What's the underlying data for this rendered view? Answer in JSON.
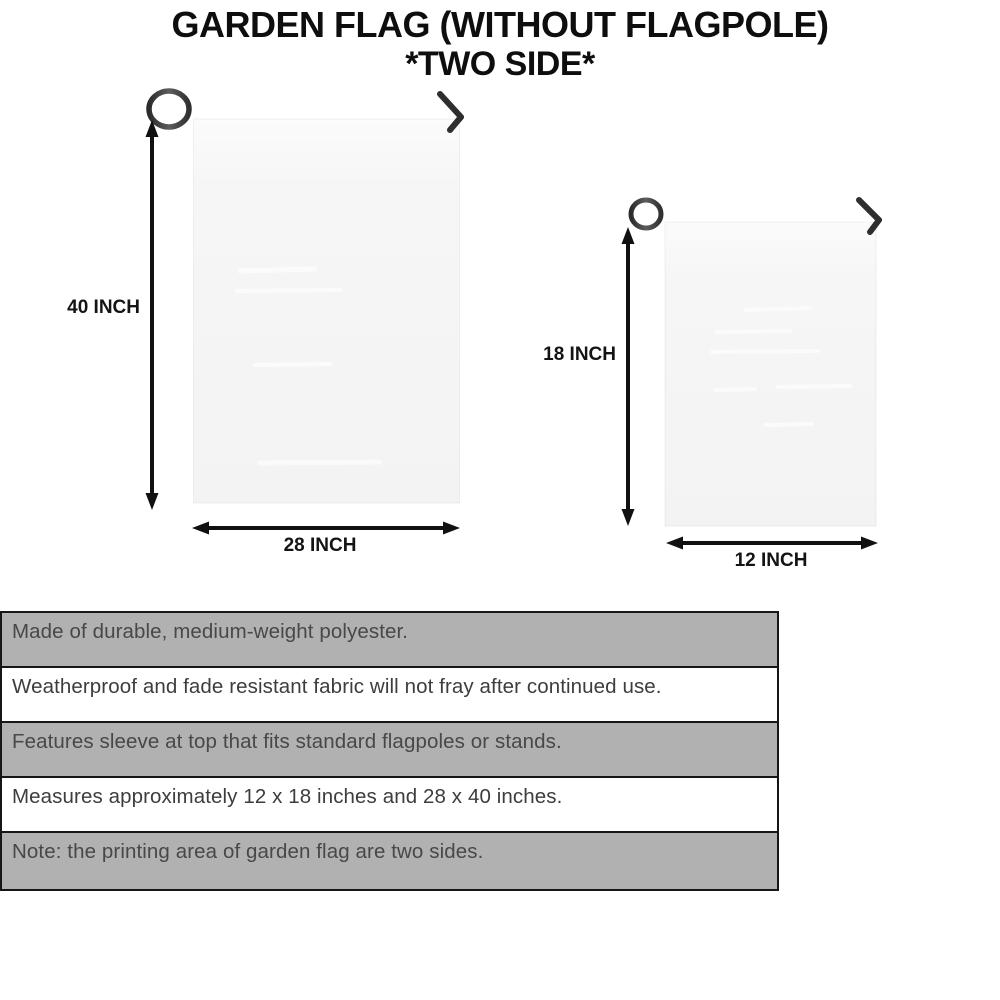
{
  "title": {
    "line1": "GARDEN FLAG (WITHOUT FLAGPOLE)",
    "line2": "*TWO SIDE*"
  },
  "large_flag": {
    "name": "28 x 40 inch garden flag",
    "height_label": "40 INCH",
    "width_label": "28 INCH"
  },
  "small_flag": {
    "name": "12 x 18 inch garden flag",
    "height_label": "18 INCH",
    "width_label": "12 INCH"
  },
  "features": {
    "rows": [
      {
        "text": "Made of durable, medium-weight polyester."
      },
      {
        "text": "Weatherproof and fade resistant fabric will not fray after continued use."
      },
      {
        "text": "Features sleeve at top that fits standard flagpoles or stands."
      },
      {
        "text": "Measures approximately 12 x 18 inches and 28 x 40 inches."
      },
      {
        "text": "Note: the printing area of garden flag are two sides."
      }
    ]
  },
  "colors": {
    "title_text": "#0e0e0e",
    "arrow": "#111111",
    "pole": "#454545",
    "hook": "#2e2e2e",
    "flag_fill": "#f5f5f5",
    "row_shaded": "#b1b1b1",
    "row_plain": "#ffffff",
    "table_border": "#161616"
  }
}
